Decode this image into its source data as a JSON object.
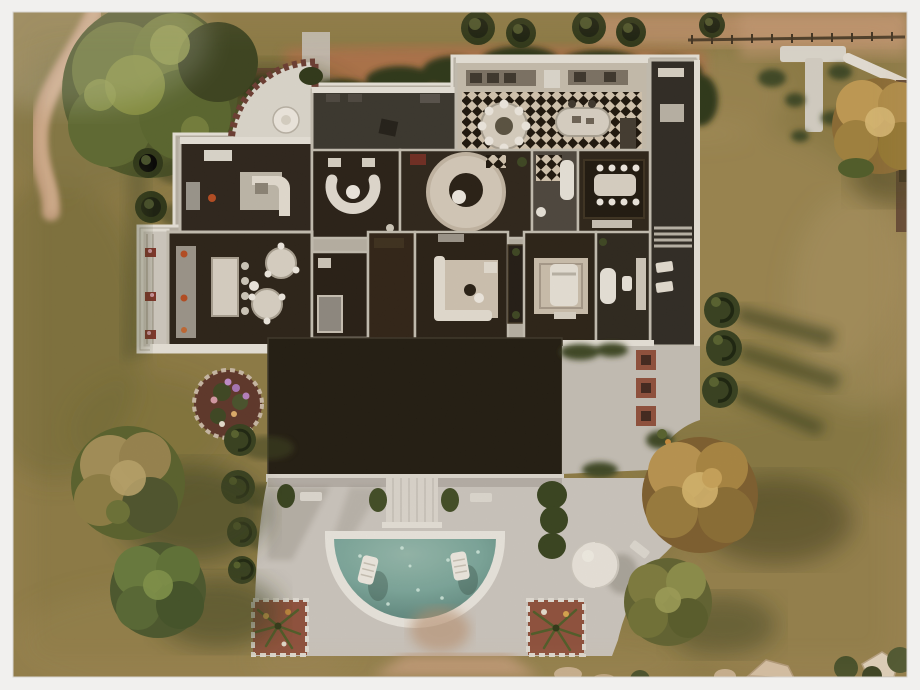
{
  "meta": {
    "title": "Top-down aerial screenshot of a mansion lot with semicircular pool",
    "style": "game lot overview photo with white gallery frame"
  },
  "frame": {
    "background": "#f1f0ee",
    "border_px": 13
  },
  "palette": {
    "grass_base": "#8c7a44",
    "grass_light": "#a8905a",
    "grass_dark": "#6e662f",
    "shadow_olive": "#3a3f1c",
    "dirt_path": "#c7a181",
    "road_band": "#bd8f69",
    "red_path": "#b0704a",
    "hedge": "#2c3516",
    "cypress": "#2b3415",
    "tree_green": "#6a7434",
    "tree_green_light": "#939c4a",
    "tree_autumn": "#b9934e",
    "tree_autumn_light": "#d6b56c",
    "tree_tan": "#a38d56",
    "wall_trim": "#e8e3db",
    "wall_mid": "#b7b0a4",
    "floor_dark": "#271f14",
    "rug_light": "#d3c8b8",
    "checker_light": "#d3c5b0",
    "checker_dark": "#191209",
    "roof_black": "#1e180f",
    "patio": "#ccc6bf",
    "deck_white": "#dcd7cf",
    "pool_rim": "#ebe7e0",
    "pool_water": "#7aa69b",
    "pool_water_deep": "#578078",
    "planter_brick": "#8f4e3a",
    "flower_purple": "#a875b8",
    "furniture_white": "#e4ded3",
    "dome_white": "#eae5dd"
  },
  "lot": {
    "building": {
      "wings": [
        "curved-terrace",
        "lounge",
        "open-terrace",
        "checkered-ballroom",
        "east-porch"
      ],
      "rooms": [
        {
          "id": "curved-terrace",
          "floor": "white stone, crenellated brick rim, parasol table"
        },
        {
          "id": "lounge",
          "floor": "dark wood, white J-shaped counter"
        },
        {
          "id": "open-terrace",
          "floor": "dark gravel, café table"
        },
        {
          "id": "ballroom",
          "floor": "black-white diamond checker, round dining table, oval island"
        },
        {
          "id": "sitting-room",
          "floor": "dark wood, white U-sofa"
        },
        {
          "id": "office",
          "floor": "round rug with circular desk"
        },
        {
          "id": "bathroom-upper",
          "floor": "checker shower and tub"
        },
        {
          "id": "dining-room",
          "floor": "long table, eight chairs, dark rug"
        },
        {
          "id": "kitchen",
          "floor": "island with stools, two round tables"
        },
        {
          "id": "bathroom-small",
          "floor": "shower cabin"
        },
        {
          "id": "family-room",
          "floor": "white corner sofa on rug"
        },
        {
          "id": "bedroom",
          "floor": "patterned rug, white bed"
        },
        {
          "id": "ensuite",
          "floor": "freestanding tub, toilet, vanity"
        },
        {
          "id": "east-porch",
          "floor": "two white loungers, exterior stair"
        }
      ],
      "roof": {
        "shape": "large flat black rectangle",
        "color_key": "roof_black"
      }
    },
    "pool": {
      "shape": "semicircle, flat side up",
      "loungers": 2,
      "dome_structure": true
    },
    "trees": {
      "large_green_top_left": 1,
      "cypress_row_top": 5,
      "cypress_left_pair": 2,
      "spiral_topiaries_left": 4,
      "spiral_topiaries_right": 3,
      "autumn_trees": 3,
      "round_trees_bottom_left": 2,
      "olive_tree_bottom_right": 1
    },
    "paths": [
      "winding dirt path top-left",
      "dirt road along top edge",
      "red path behind house",
      "T-shaped paved path top-right",
      "dirt path below patio"
    ],
    "planters": [
      "circular purple flower bed",
      "two brick palm planters at patio corners",
      "three brick square planters on east walk"
    ]
  }
}
